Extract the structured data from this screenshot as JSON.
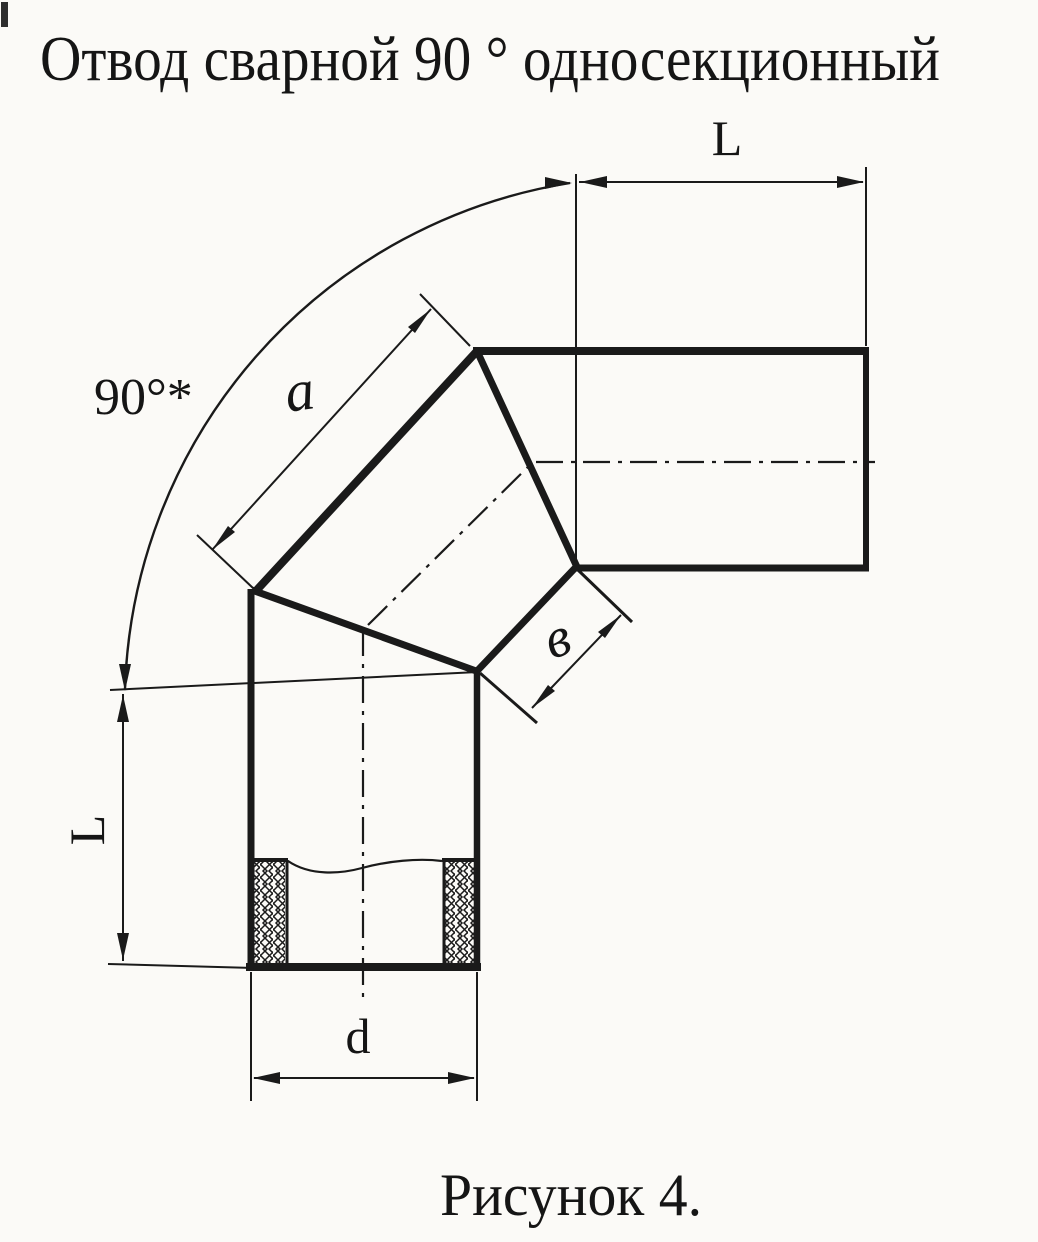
{
  "page": {
    "title": "Отвод сварной 90 ° односекционный",
    "caption": "Рисунок 4."
  },
  "labels": {
    "angle": "90°*",
    "a": "a",
    "b": "в",
    "d": "d",
    "l_top": "L",
    "l_left": "L"
  },
  "colors": {
    "ink": "#1a1a1a",
    "paper": "#fbfaf7"
  }
}
